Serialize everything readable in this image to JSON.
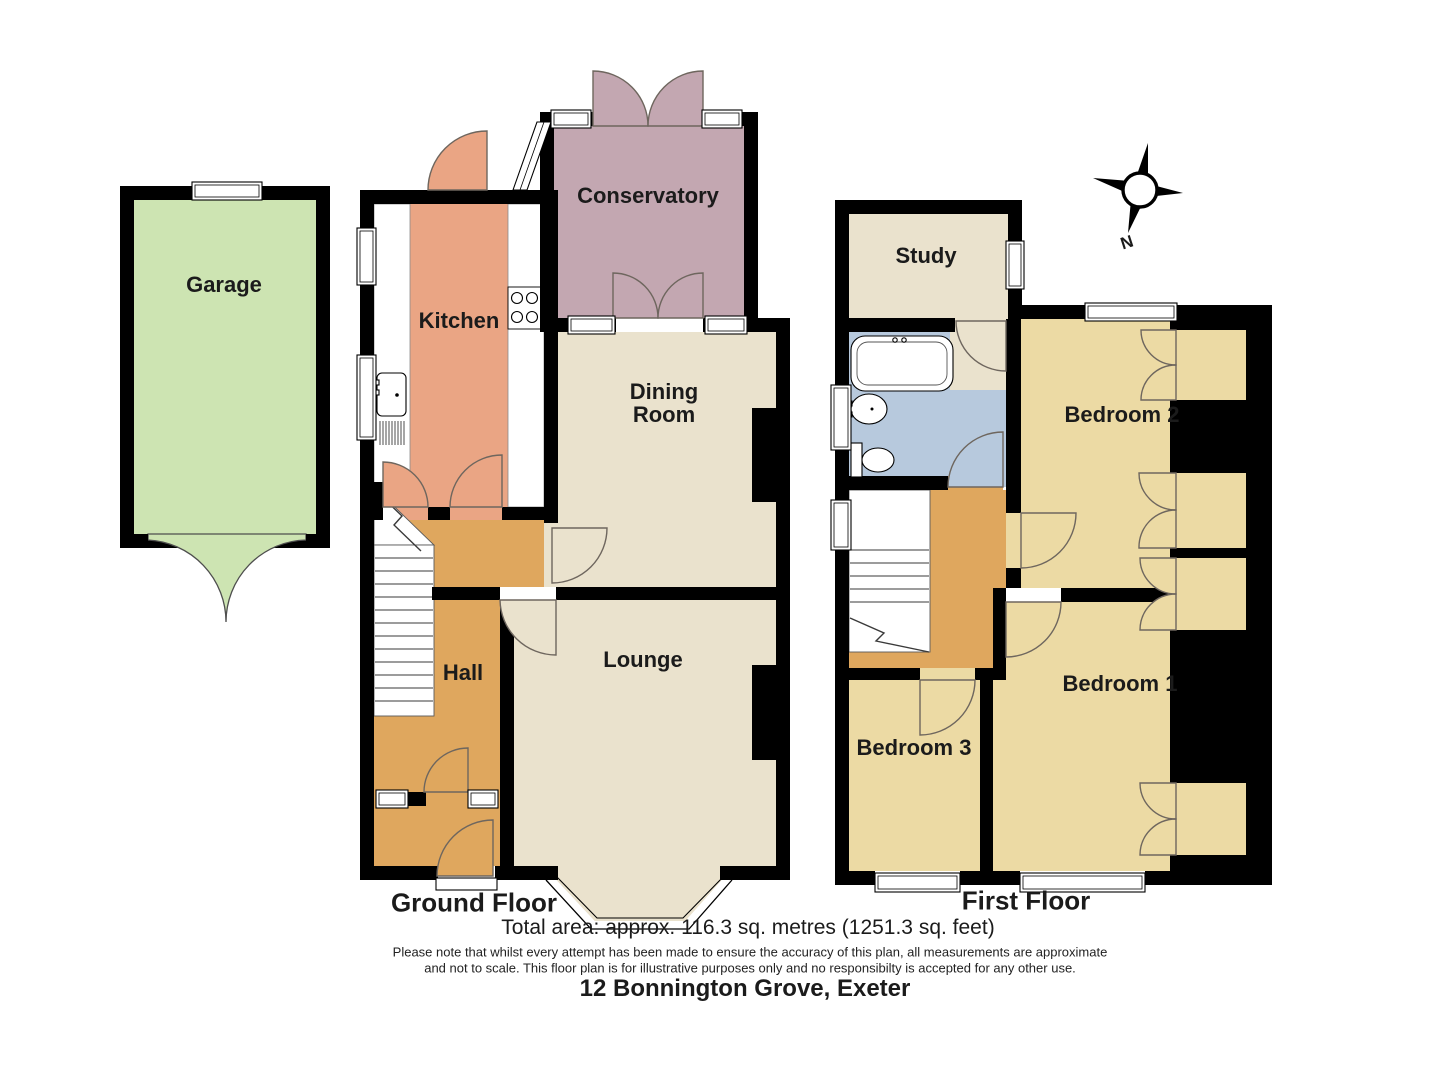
{
  "title": "12 Bonnington Grove, Exeter",
  "captions": {
    "ground_floor": "Ground Floor",
    "first_floor": "First Floor"
  },
  "summary": {
    "total_area": "Total area: approx. 116.3 sq. metres (1251.3 sq. feet)"
  },
  "disclaimer": {
    "line1": "Please note that whilst every attempt has been made to ensure the accuracy of this plan, all measurements are approximate",
    "line2": "and not to scale. This floor plan is for illustrative purposes only and no responsibilty is accepted for any other use."
  },
  "compass": {
    "north_label": "N"
  },
  "rooms": {
    "garage": "Garage",
    "kitchen": "Kitchen",
    "conservatory": "Conservatory",
    "dining_room": "Dining\nRoom",
    "hall": "Hall",
    "lounge": "Lounge",
    "study": "Study",
    "bedroom1": "Bedroom 1",
    "bedroom2": "Bedroom 2",
    "bedroom3": "Bedroom 3"
  },
  "colors": {
    "wall": "#000000",
    "garage": "#cde4b2",
    "kitchen": "#eaa584",
    "conservatory": "#c3a7b1",
    "cream": "#eae2cd",
    "hall": "#dfa75e",
    "bedroom": "#ecdaa4",
    "bathroom": "#b7c9dd"
  }
}
